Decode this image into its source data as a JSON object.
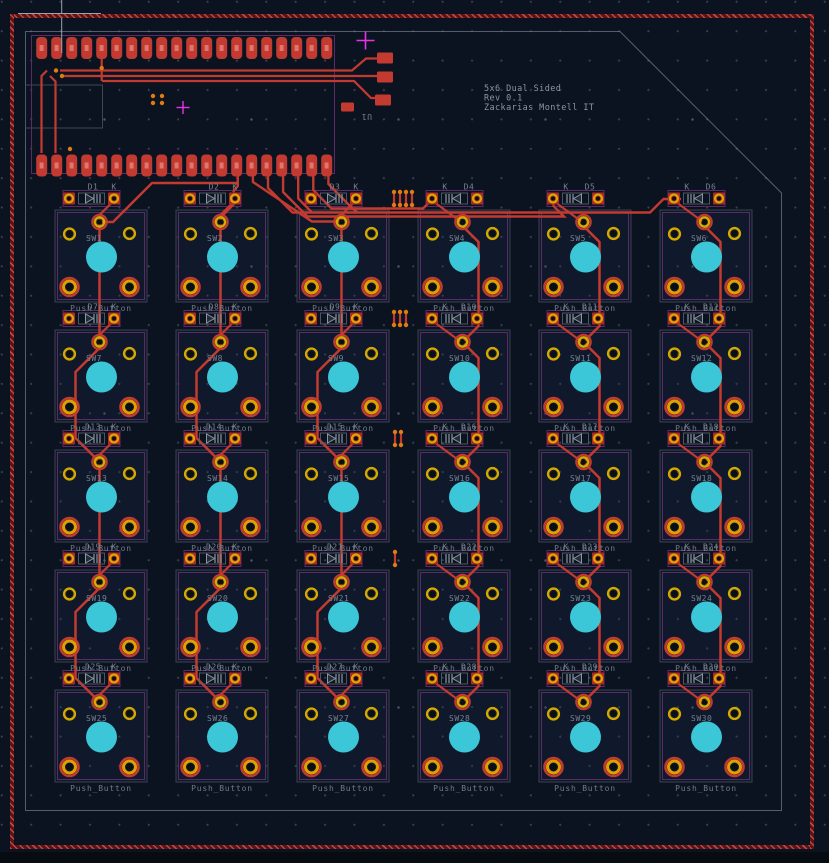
{
  "board": {
    "title_block": {
      "line1": "5x6 Dual Sided",
      "line2": "Rev 0.1",
      "line3": "Zackarias Montell IT"
    },
    "connector": {
      "ref": "U1"
    },
    "diode_cathode_label": "K",
    "switch_value": "Push_Button",
    "switches": [
      "SW1",
      "SW2",
      "SW3",
      "SW4",
      "SW5",
      "SW6",
      "SW7",
      "SW8",
      "SW9",
      "SW10",
      "SW11",
      "SW12",
      "SW13",
      "SW14",
      "SW15",
      "SW16",
      "SW17",
      "SW18",
      "SW19",
      "SW20",
      "SW21",
      "SW22",
      "SW23",
      "SW24",
      "SW25",
      "SW26",
      "SW27",
      "SW28",
      "SW29",
      "SW30"
    ],
    "diodes": [
      "D1",
      "D2",
      "D3",
      "D4",
      "D5",
      "D6",
      "D7",
      "D8",
      "D9",
      "D10",
      "D11",
      "D12",
      "D13",
      "D14",
      "D15",
      "D16",
      "D17",
      "D18",
      "D19",
      "D20",
      "D21",
      "D22",
      "D23",
      "D24",
      "D25",
      "D26",
      "D27",
      "D28",
      "D29",
      "D30"
    ],
    "colors": {
      "background": "#0c1320",
      "copper_front": "#c23a30",
      "pad_gold": "#d6a900",
      "pad_inner_gold": "#e0a000",
      "via_orange": "#e07b12",
      "silkscreen_gray": "#7d8a95",
      "courtyard_purple": "#5a2b66",
      "zone_gray": "#667180",
      "switch_cap_cyan": "#3bc7d7",
      "edge_dark_red": "#571616",
      "edge_tick_red": "#c54343",
      "marker_magenta": "#e832e8"
    }
  }
}
